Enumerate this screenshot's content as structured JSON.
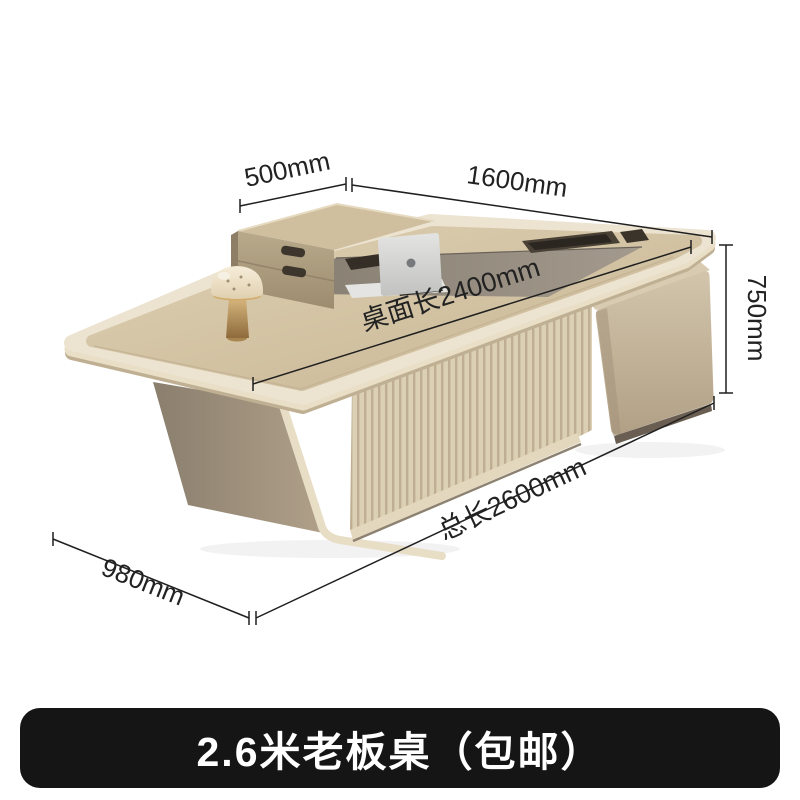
{
  "banner": {
    "title": "2.6米老板桌（包邮）",
    "background": "#151515",
    "text_color": "#ffffff"
  },
  "dimensions": {
    "return_depth": "500mm",
    "main_top_width": "1600mm",
    "height": "750mm",
    "desktop_length": "桌面长2400mm",
    "total_length": "总长2600mm",
    "side_depth": "980mm"
  },
  "colors": {
    "dimension_line": "#1f1f1f",
    "label_text": "#222222",
    "desk_wood": "#d5c6a8",
    "desk_edge_cream": "#ece3d0",
    "inset_panel_dark": "#877d71",
    "leg_taupe": "#9a8d79",
    "fluted_panel": "#d9cdb2",
    "cabinet_leather": "#c7b89e",
    "banner_background": "#151515",
    "page_background": "#ffffff"
  }
}
